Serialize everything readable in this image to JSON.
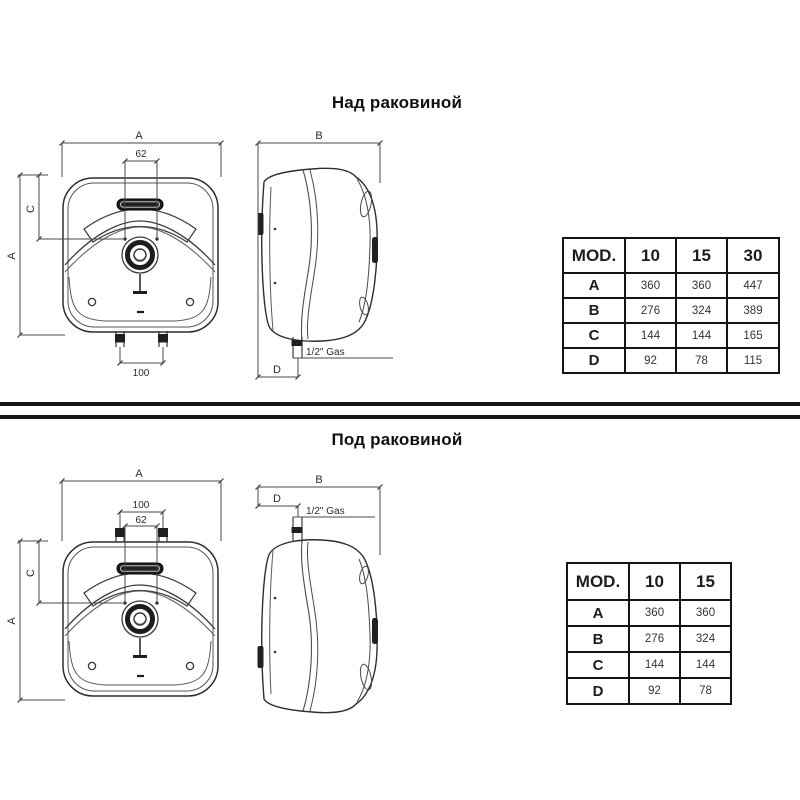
{
  "titles": {
    "above": "Над раковиной",
    "below": "Под раковиной"
  },
  "dim_labels": {
    "a": "A",
    "b": "B",
    "c": "C",
    "d": "D",
    "w62": "62",
    "w100": "100",
    "gas": "1/2\" Gas"
  },
  "tables": {
    "above": {
      "header": [
        "MOD.",
        "10",
        "15",
        "30"
      ],
      "rows": [
        [
          "A",
          "360",
          "360",
          "447"
        ],
        [
          "B",
          "276",
          "324",
          "389"
        ],
        [
          "C",
          "144",
          "144",
          "165"
        ],
        [
          "D",
          "92",
          "78",
          "115"
        ]
      ]
    },
    "below": {
      "header": [
        "MOD.",
        "10",
        "15"
      ],
      "rows": [
        [
          "A",
          "360",
          "360"
        ],
        [
          "B",
          "276",
          "324"
        ],
        [
          "C",
          "144",
          "144"
        ],
        [
          "D",
          "92",
          "78"
        ]
      ]
    }
  }
}
